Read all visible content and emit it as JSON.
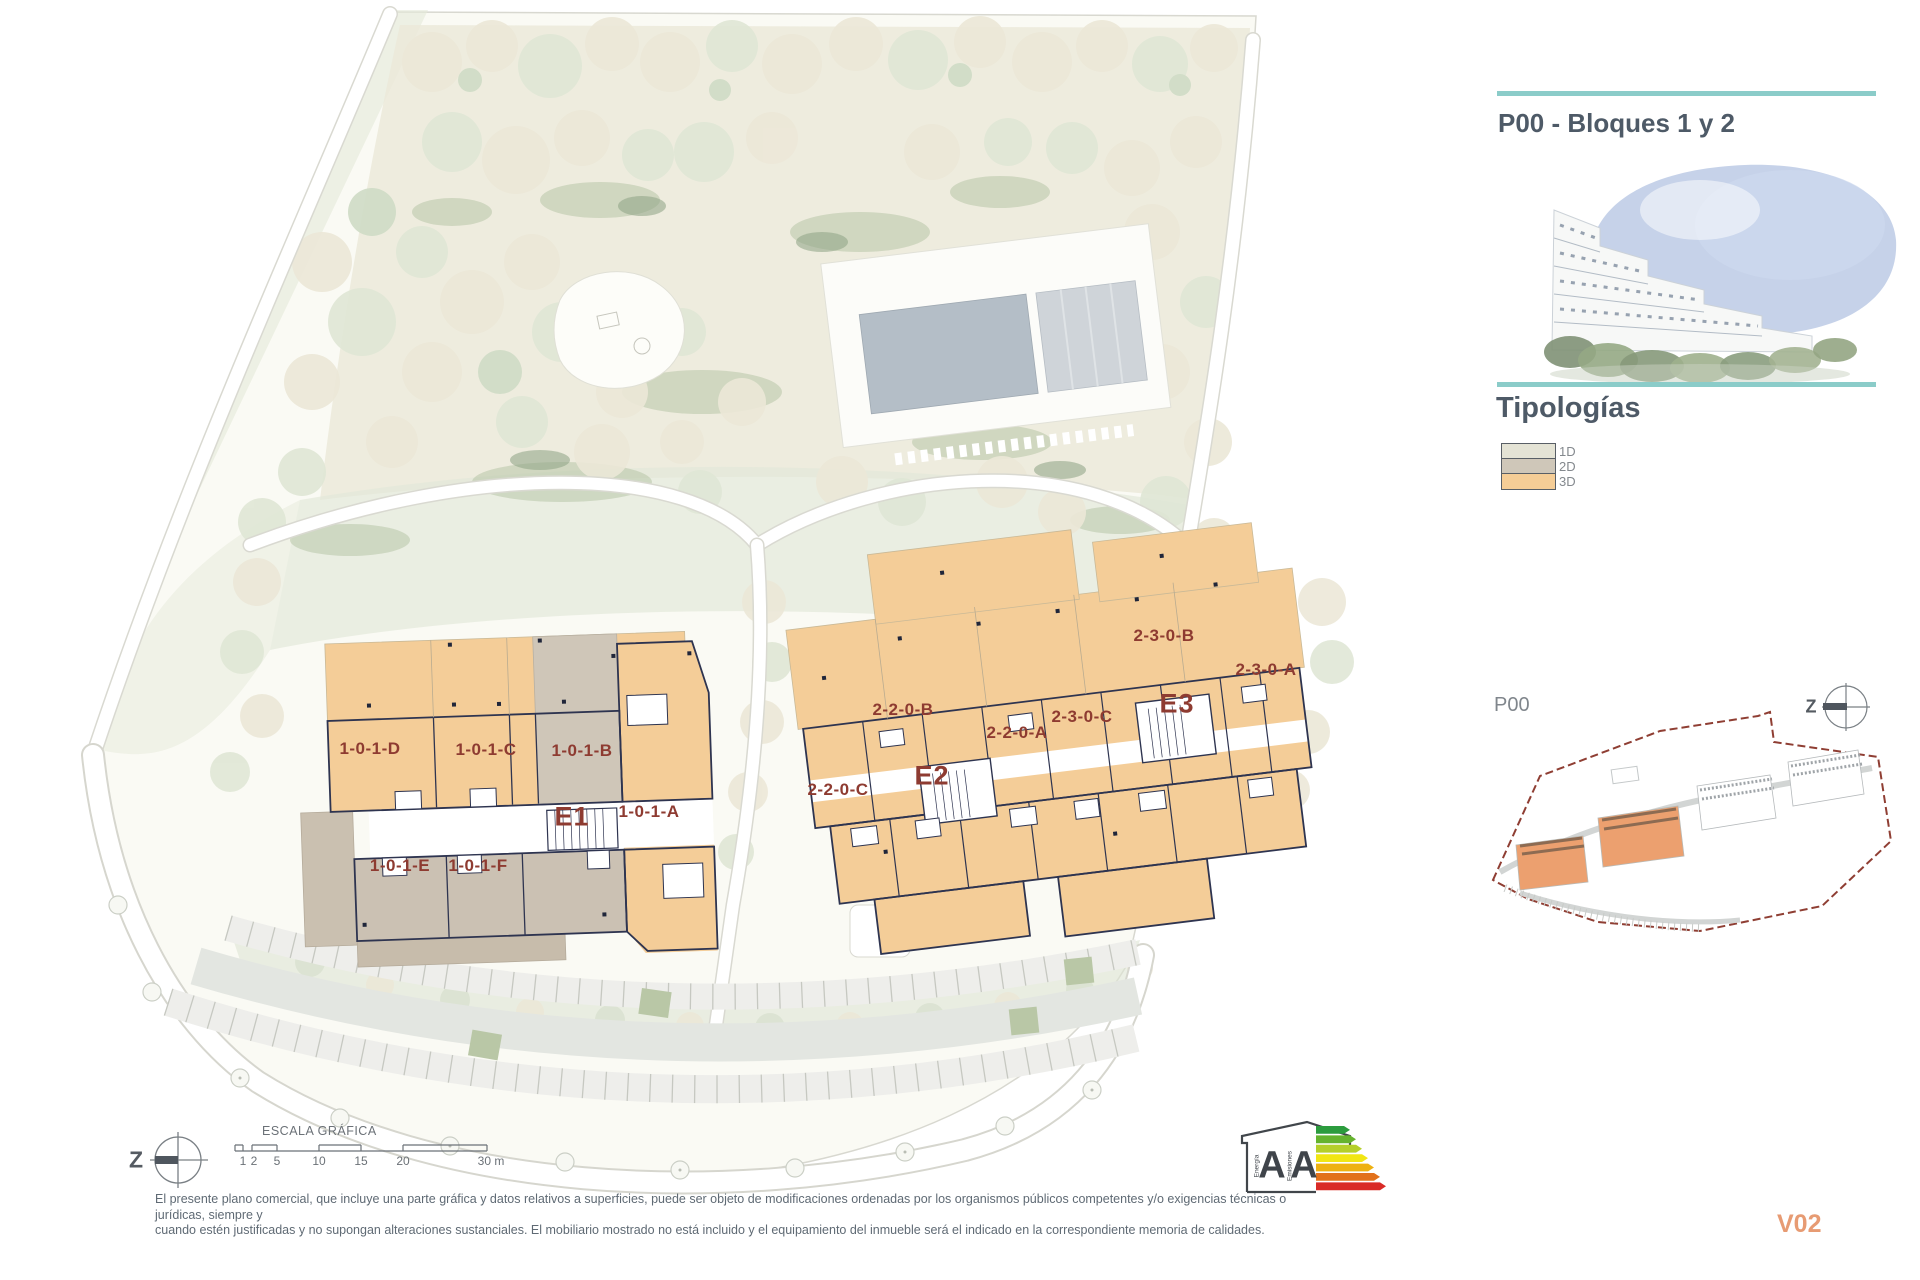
{
  "right_panel": {
    "title": "P00 - Bloques 1 y 2",
    "typologies_title": "Tipologías",
    "legend": [
      {
        "label": "1D",
        "color": "#e4e3d5"
      },
      {
        "label": "2D",
        "color": "#cfc7b9"
      },
      {
        "label": "3D",
        "color": "#f5cd96"
      }
    ],
    "keyplan_label": "P00"
  },
  "plan": {
    "labels": [
      {
        "text": "1-0-1-D"
      },
      {
        "text": "1-0-1-C"
      },
      {
        "text": "1-0-1-B"
      },
      {
        "text": "1-0-1-A"
      },
      {
        "text": "1-0-1-E"
      },
      {
        "text": "1-0-1-F"
      },
      {
        "text": "E1"
      },
      {
        "text": "2-2-0-C"
      },
      {
        "text": "2-2-0-B"
      },
      {
        "text": "E2"
      },
      {
        "text": "2-2-0-A"
      },
      {
        "text": "2-3-0-C"
      },
      {
        "text": "2-3-0-B"
      },
      {
        "text": "E3"
      },
      {
        "text": "2-3-0-A"
      }
    ],
    "colors": {
      "typology_1d": "#e4e3d5",
      "typology_2d": "#cfc7b9",
      "typology_3d": "#f5cd96",
      "walls": "#2e3450",
      "unit_label": "#8e3b31"
    }
  },
  "compass": {
    "letter": "Z"
  },
  "scale_bar": {
    "title": "ESCALA GRÁFICA",
    "ticks": [
      "1",
      "2",
      "5",
      "10",
      "15",
      "20",
      "30 m"
    ]
  },
  "energy_badge": {
    "letter_energy": "A",
    "letter_emissions": "A",
    "caption_energy": "Energía",
    "caption_emissions": "Emisiones"
  },
  "footer": {
    "disclaimer_line1": "El presente plano comercial, que incluye una parte gráfica y datos relativos a superficies, puede ser objeto de modificaciones ordenadas por los organismos públicos competentes y/o exigencias técnicas o jurídicas, siempre y",
    "disclaimer_line2": "cuando estén justificadas y no supongan alteraciones sustanciales. El mobiliario mostrado no está incluido y el equipamiento del inmueble será el indicado en la correspondiente memoria de calidades.",
    "version": "V02"
  }
}
